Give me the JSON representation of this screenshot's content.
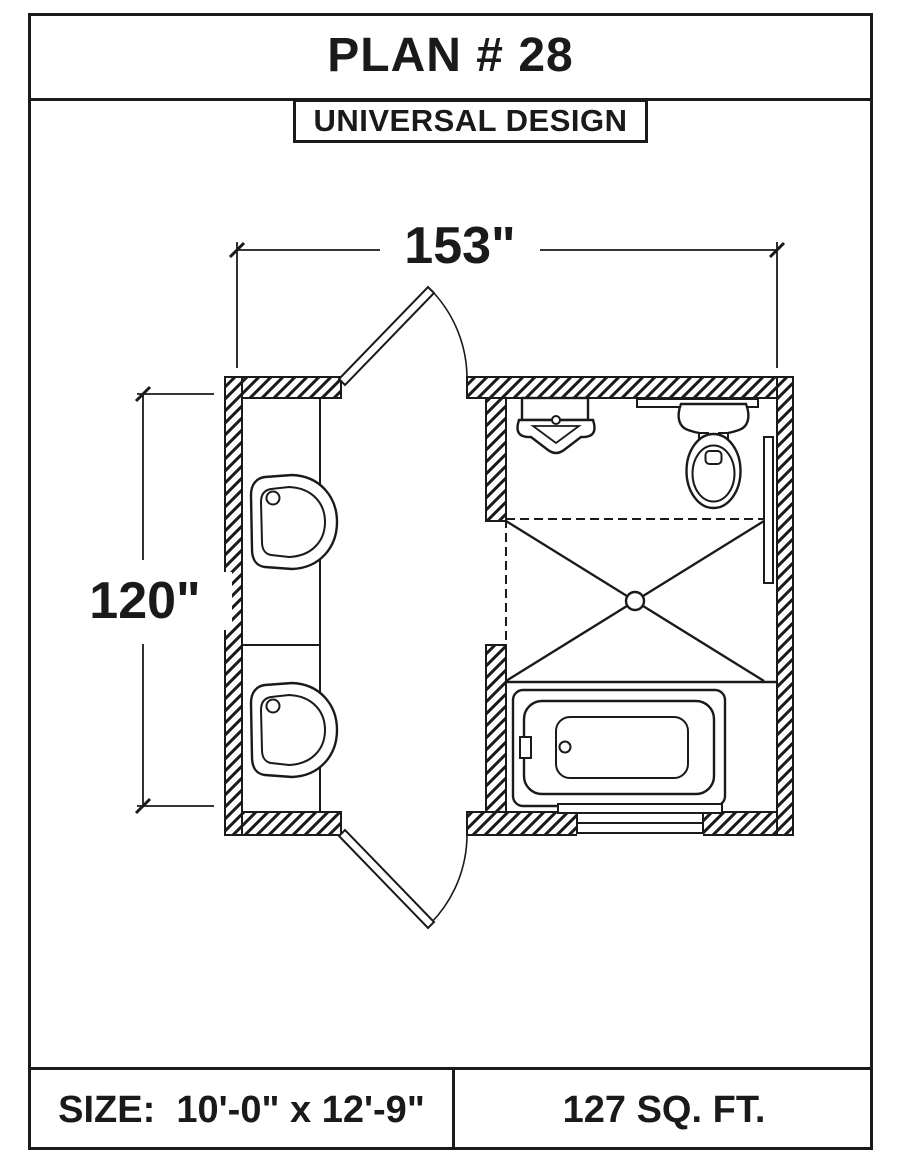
{
  "header": {
    "title": "PLAN # 28",
    "badge": "UNIVERSAL DESIGN"
  },
  "dimensions": {
    "width": "153\"",
    "height": "120\""
  },
  "footer": {
    "size_label": "SIZE:  10'-0\" x 12'-9\"",
    "area_label": "127 SQ. FT."
  },
  "colors": {
    "line": "#1a1a1a",
    "paper": "#ffffff"
  },
  "plan": {
    "type": "bathroom-floor-plan",
    "fixtures": [
      "vanity-counter",
      "vanity-sink",
      "vanity-sink",
      "corner-sink",
      "toilet",
      "grab-bar",
      "grab-bar",
      "shower-with-drain",
      "bathtub",
      "window",
      "swing-door",
      "swing-door"
    ]
  }
}
